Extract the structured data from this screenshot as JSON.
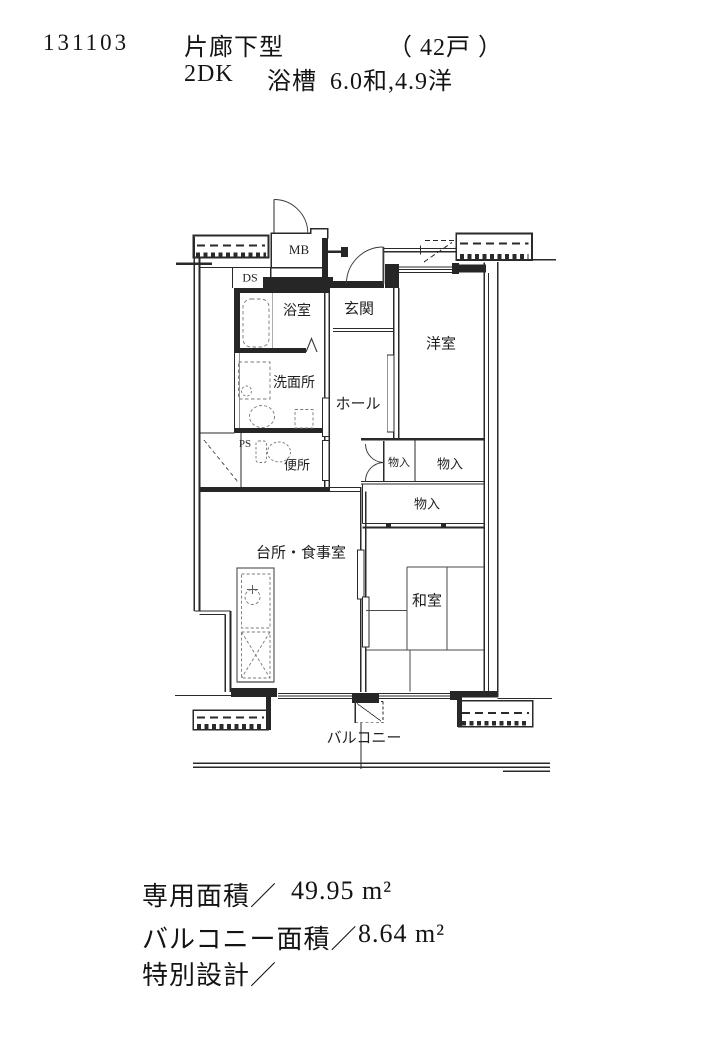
{
  "header": {
    "plan_number": "131103",
    "plan_type": "片廊下型",
    "unit_count": "（ 42戸 ）",
    "layout": "2DK",
    "bath_label": "浴槽",
    "room_sizes": "6.0和,4.9洋"
  },
  "floor_plan": {
    "labels": {
      "meter_box": "MB",
      "duct_space": "DS",
      "pipe_space": "PS",
      "bathroom": "浴室",
      "entrance": "玄関",
      "western_room": "洋室",
      "washroom": "洗面所",
      "hall": "ホール",
      "toilet": "便所",
      "closet_1": "物入",
      "closet_2": "物入",
      "closet_3": "物入",
      "kitchen_dining": "台所・食事室",
      "japanese_room": "和室",
      "balcony": "バルコニー"
    }
  },
  "footer": {
    "lines": [
      {
        "label": "専用面積／",
        "value": "49.95 m²"
      },
      {
        "label": "バルコニー面積／",
        "value": "8.64 m²"
      },
      {
        "label": "特別設計／",
        "value": ""
      }
    ]
  }
}
